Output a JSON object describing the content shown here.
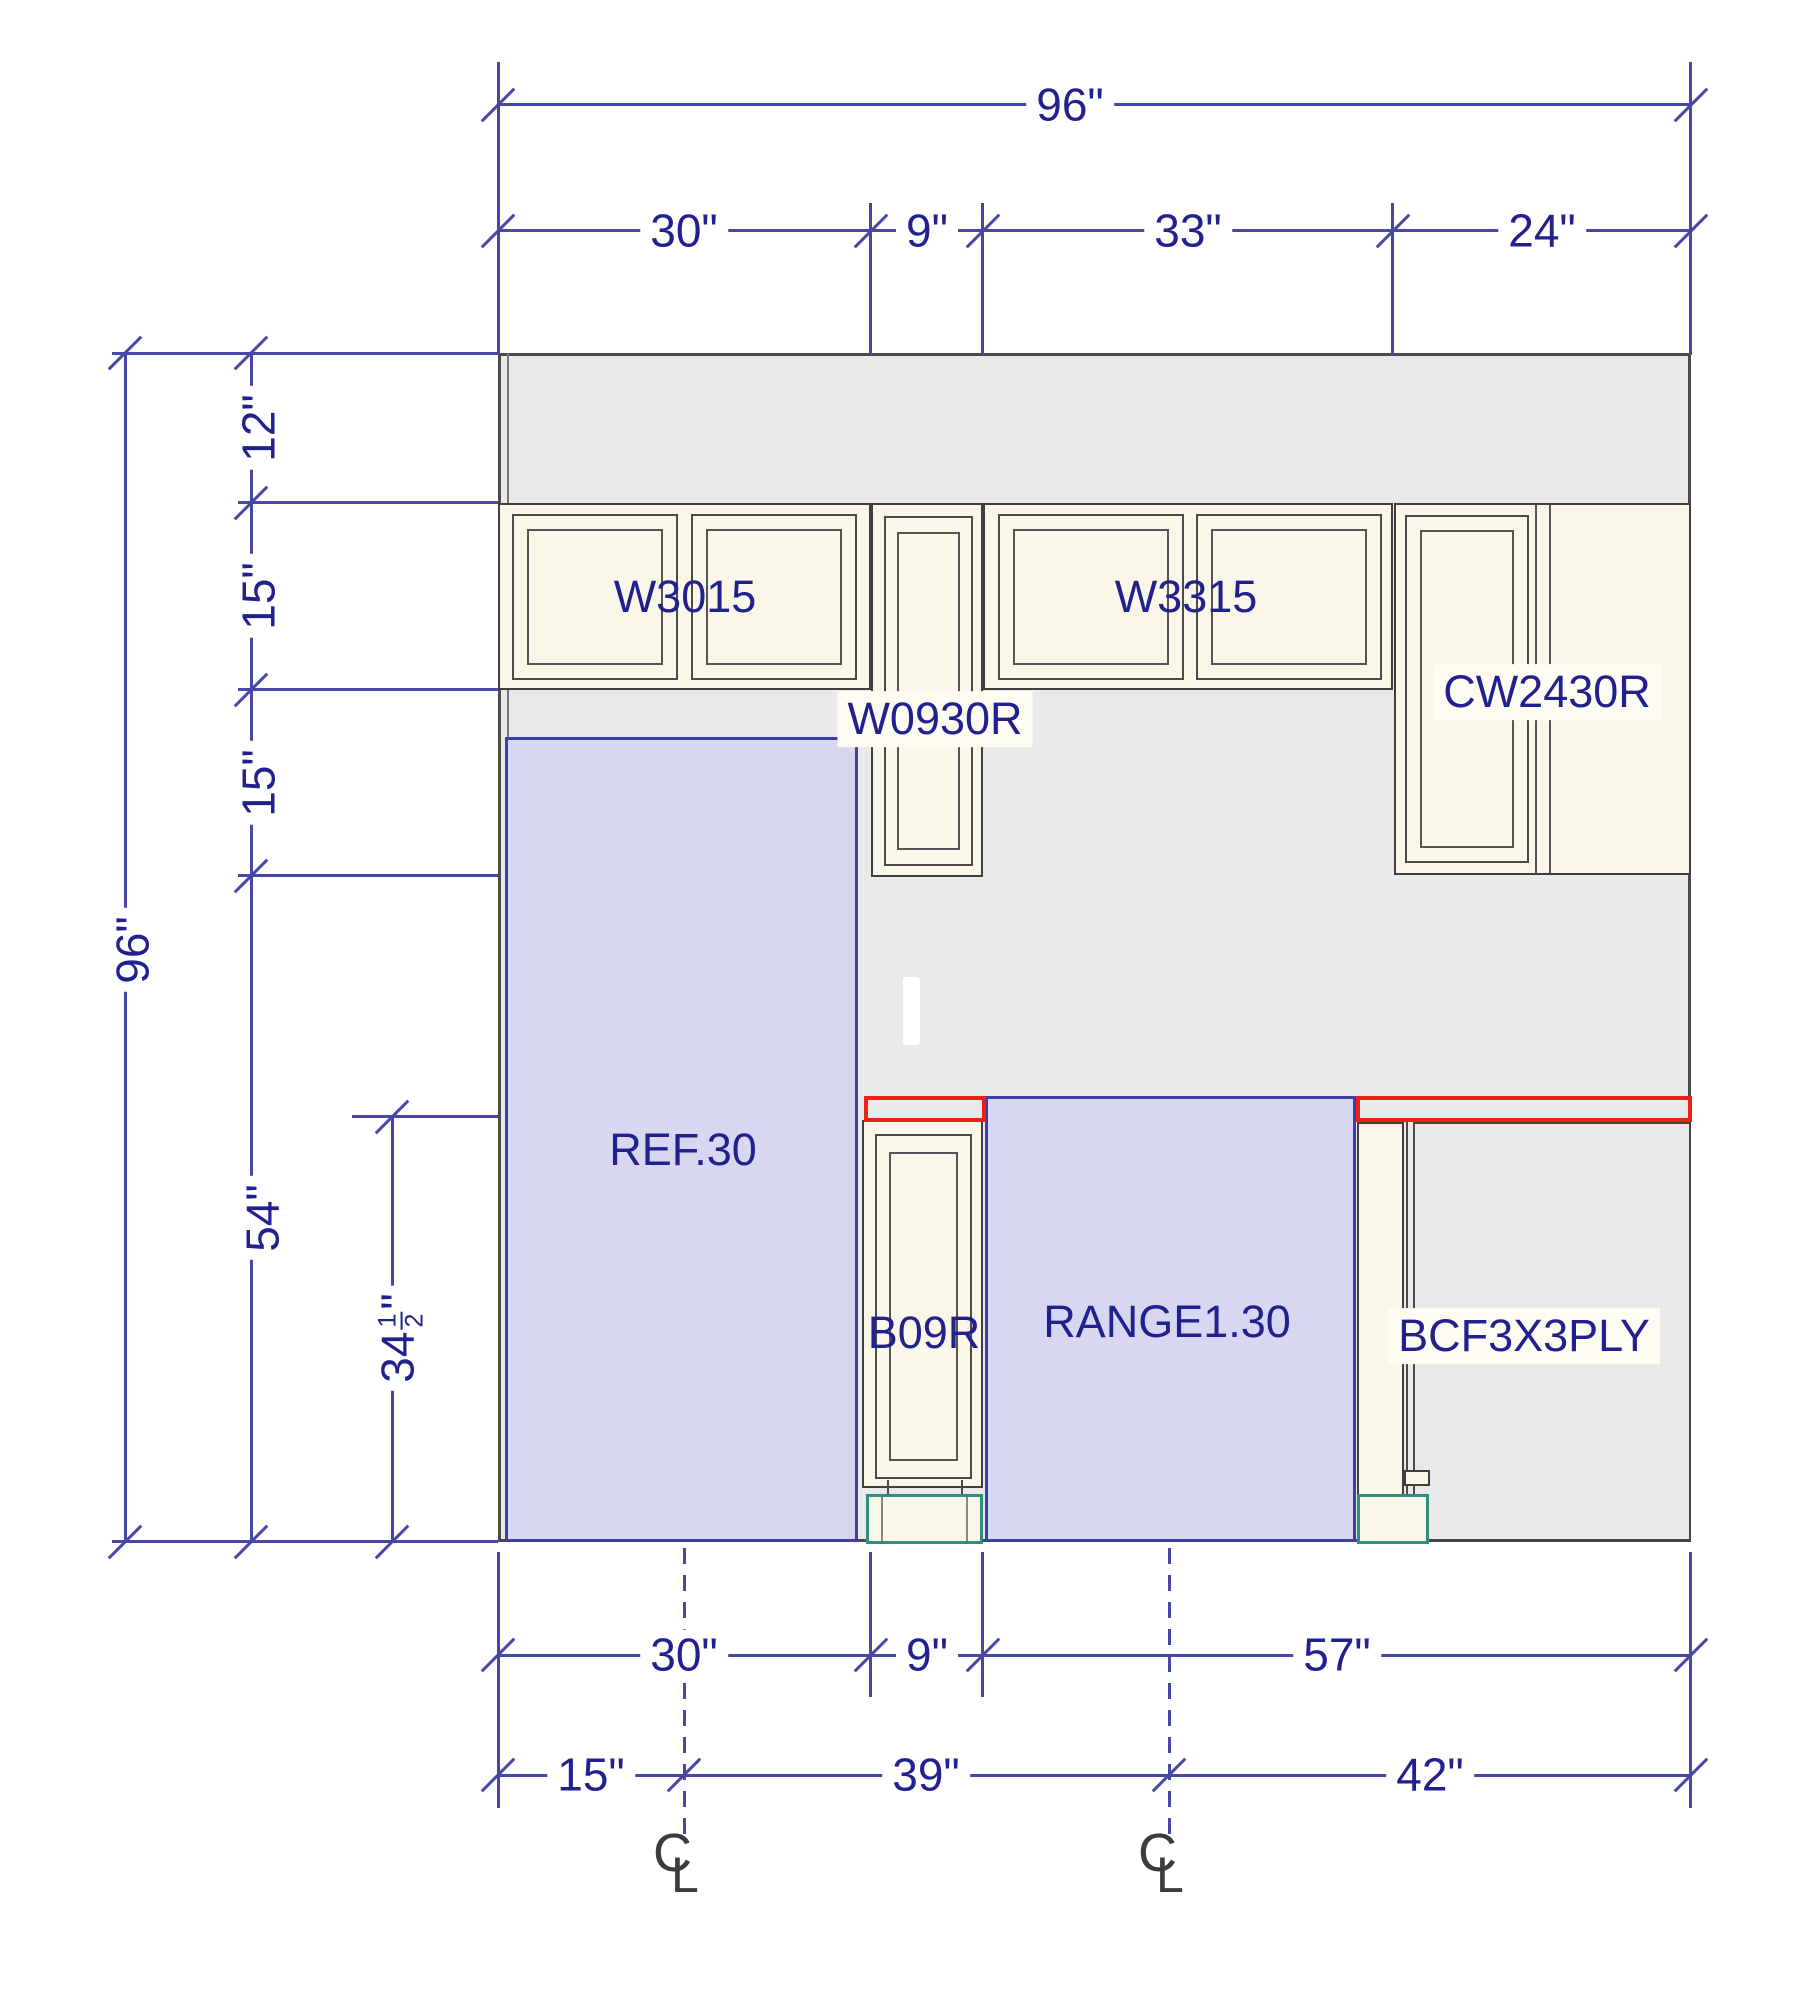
{
  "labels": {
    "w3015": "W3015",
    "w3315": "W3315",
    "w0930r": "W0930R",
    "cw2430r": "CW2430R",
    "ref": "REF.30",
    "b09r": "B09R",
    "range": "RANGE1.30",
    "bcf": "BCF3X3PLY"
  },
  "dims": {
    "top_total": "96\"",
    "top_seg_30": "30\"",
    "top_seg_9": "9\"",
    "top_seg_33": "33\"",
    "top_seg_24": "24\"",
    "left_total": "96\"",
    "left_seg_12": "12\"",
    "left_seg_15a": "15\"",
    "left_seg_15b": "15\"",
    "left_seg_54": "54\"",
    "left_frac_whole": "34",
    "left_frac_num": "1",
    "left_frac_den": "2",
    "left_frac_unit": "\"",
    "bot1_30": "30\"",
    "bot1_9": "9\"",
    "bot1_57": "57\"",
    "bot2_15": "15\"",
    "bot2_39": "39\"",
    "bot2_42": "42\"",
    "centerline_c": "C",
    "centerline_l": "L"
  },
  "colors": {
    "wall_gray": "#e9e9ea",
    "cabinet_cream": "#faf7e9",
    "outline_dark": "#4b4b4b",
    "highlight_purple": "#d8d7f2",
    "purple_border": "#3e3ea8",
    "dimension_blue": "#4747a8",
    "text_navy": "#20208e",
    "appliance_red": "#ee1f17",
    "toekick_teal": "#2f8e7e"
  }
}
